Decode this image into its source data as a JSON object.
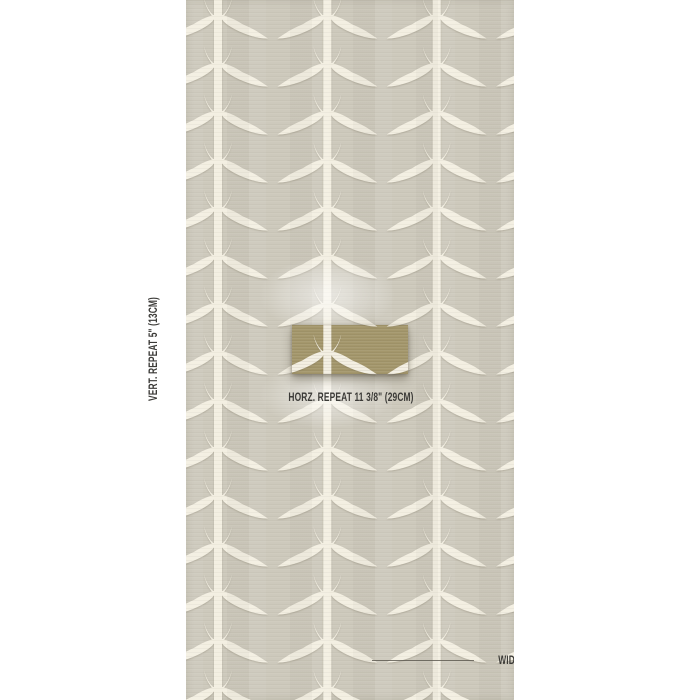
{
  "image": {
    "type": "wallpaper-dimension-diagram",
    "page_background": "#ffffff"
  },
  "swatch": {
    "ground_color": "#cdc9bc",
    "motif_color": "#f3efe2",
    "motif_name": "acanthus-leaf-stripe"
  },
  "highlight_box": {
    "color": "#a4976c",
    "represents": "one horizontal repeat"
  },
  "labels": {
    "vertical_repeat": "VERT. REPEAT 5\" (13CM)",
    "horizontal_repeat": "HORZ. REPEAT 11 3/8\" (29CM)",
    "width": "WIDTH 34\" (86CM)"
  },
  "annotation_style": {
    "text_color": "#3b3a37",
    "rule_color": "#5a564e"
  }
}
